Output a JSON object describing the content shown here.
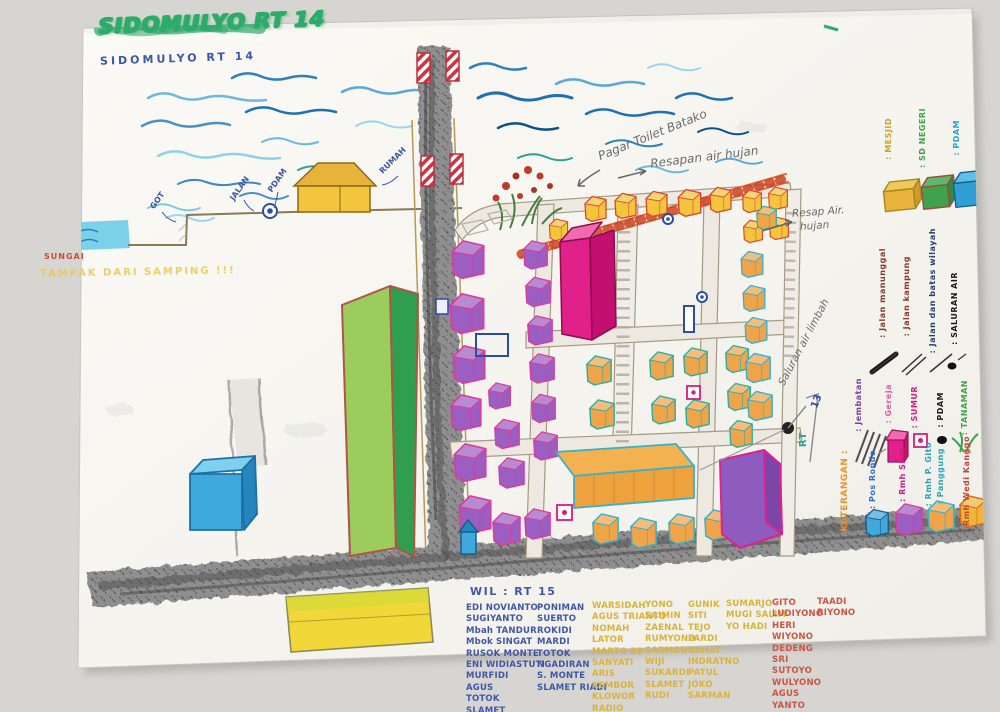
{
  "title": {
    "marker": "SIDOMULYO RT 14",
    "pen": "SIDOMULYO RT 14"
  },
  "annotations": {
    "pagar_toilet": "Pagar Toilet Batako",
    "resapan_air": "Resapan air hujan",
    "resap_air_line1": "Resap Air.",
    "resap_air_line2": "hujan",
    "saluran_limbah": "Saluran air limbah",
    "rt_label": "RT",
    "rt_number": "13"
  },
  "side_view": {
    "water_label": "SUNGAI",
    "caption": "TAMPAK DARI SAMPING !!!",
    "labels": {
      "got": "GOT",
      "jalan": "JALAN",
      "pdam": "PDAM",
      "rumah": "RUMAH"
    }
  },
  "legend": {
    "keterangan": "KETERANGAN :",
    "buildings": [
      {
        "label": ": MESJID",
        "color": "#e8b33a"
      },
      {
        "label": ": SD NEGERI",
        "color": "#3fa34d"
      },
      {
        "label": ": PDAM",
        "color": "#2e9fd4"
      }
    ],
    "roads": [
      {
        "label": ": Jalan manunggal",
        "ink": "#8a3a2e"
      },
      {
        "label": ": Jalan kampung",
        "ink": "#8a3a2e"
      },
      {
        "label": ": Jalan dan batas wilayah",
        "ink": "#27406e"
      },
      {
        "label": ": SALURAN AIR",
        "ink": "#1a1a1a"
      }
    ],
    "symbols": [
      {
        "label": ": Jembatan",
        "ink": "#7b3fa0"
      },
      {
        "label": ": Gereja",
        "ink": "#e060a0"
      },
      {
        "label": ": SUMUR",
        "ink": "#d81b7f"
      },
      {
        "label": ": PDAM",
        "ink": "#1a1a1a"
      },
      {
        "label": ": TANAMAN",
        "ink": "#3fa34d"
      }
    ],
    "houses": [
      {
        "label": ": Pos Rondo",
        "ink": "#2e6fd4"
      },
      {
        "label": ": Rmh SHM",
        "ink": "#d81b7f"
      },
      {
        "label": ": Rmh P. Gito",
        "label2": ": Panggung",
        "ink": "#2aa5b8"
      },
      {
        "label": ": Rmh Wedi Kanggo",
        "ink": "#cc4433"
      }
    ]
  },
  "roster": {
    "header": "WIL : RT 15",
    "columns": [
      {
        "ink": "#3f57a8",
        "names": [
          "EDI NOVIANTO",
          "SUGIYANTO",
          "Mbah TANDUR",
          "Mbok SINGAT",
          "RUSOK MONTE",
          "ENI WIDIASTUTI",
          "MURFIDI",
          "AGUS",
          "TOTOK",
          "SLAMET"
        ]
      },
      {
        "ink": "#3f57a8",
        "names": [
          "PONIMAN",
          "SUERTO",
          "ROKIDI",
          "MARDI",
          "TOTOK",
          "NGADIRAN",
          "S. MONTE",
          "SLAMET RIADI"
        ]
      },
      {
        "ink": "#d9b33b",
        "names": [
          "WARSIDAH",
          "AGUS TRIANTO",
          "NOMAH",
          "LATOR",
          "MARTO BB",
          "SANYATI",
          "ARIS",
          "KEMBOR",
          "KLOWOR",
          "RADIO"
        ]
      },
      {
        "ink": "#d9b33b",
        "names": [
          "YONO",
          "SAIMIN",
          "ZAENAL",
          "RUMYONO",
          "SARMAN",
          "WIJI",
          "SUKARDI",
          "SLAMET",
          "RUDI"
        ]
      },
      {
        "ink": "#d9b33b",
        "names": [
          "GUNIK",
          "SITI",
          "TEJO",
          "PARDI",
          "RAHAT",
          "INDRATNO",
          "PATUL",
          "JOKO",
          "SARMAN"
        ]
      },
      {
        "ink": "#d9b33b",
        "names": [
          "SUMARJO",
          "MUGI SALIM",
          "YO HADI"
        ]
      },
      {
        "ink": "#cc5544",
        "names": [
          "GITO",
          "LUDIYONO",
          "HERI",
          "WIYONO",
          "DEDENG",
          "SRI",
          "SUTOYO",
          "WULYONO",
          "AGUS",
          "YANTO"
        ]
      },
      {
        "ink": "#cc5544",
        "names": [
          "TAADI",
          "RIYONO"
        ]
      }
    ]
  }
}
